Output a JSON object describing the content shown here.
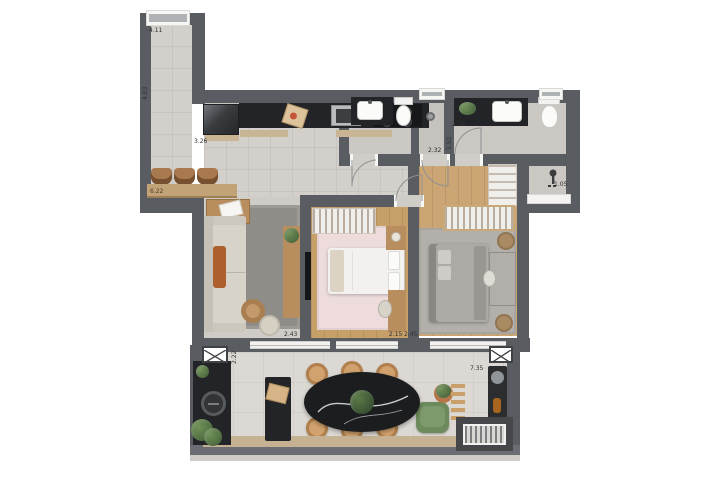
{
  "palette": {
    "wall": "#595c60",
    "floor_tile": "#d3d0cb",
    "wood_floor": "#c79f68",
    "living_rug": "#8f8d88",
    "pink_rug": "#eddcdb",
    "gray_rug": "#b3b0ab",
    "dark_counter": "#232427",
    "wood_accent": "#c2a277",
    "balcony_floor": "#dcd9d4",
    "plant_green": "#5a7d4a"
  },
  "dimensions": {
    "corridor_window": "4.11",
    "corridor_side": "4.03",
    "kitchen_run": "3.26",
    "bar_counter": "6.22",
    "bath2_width": "2.06",
    "bath_depth": "1.52",
    "bath1_width": "2.32",
    "service_nook": "1.05",
    "bedroom1_width": "2.43",
    "bedroom2_entry": "2.15",
    "bedroom2_width": "2.45",
    "balcony_depth": "2.22",
    "balcony_width": "7.35"
  }
}
